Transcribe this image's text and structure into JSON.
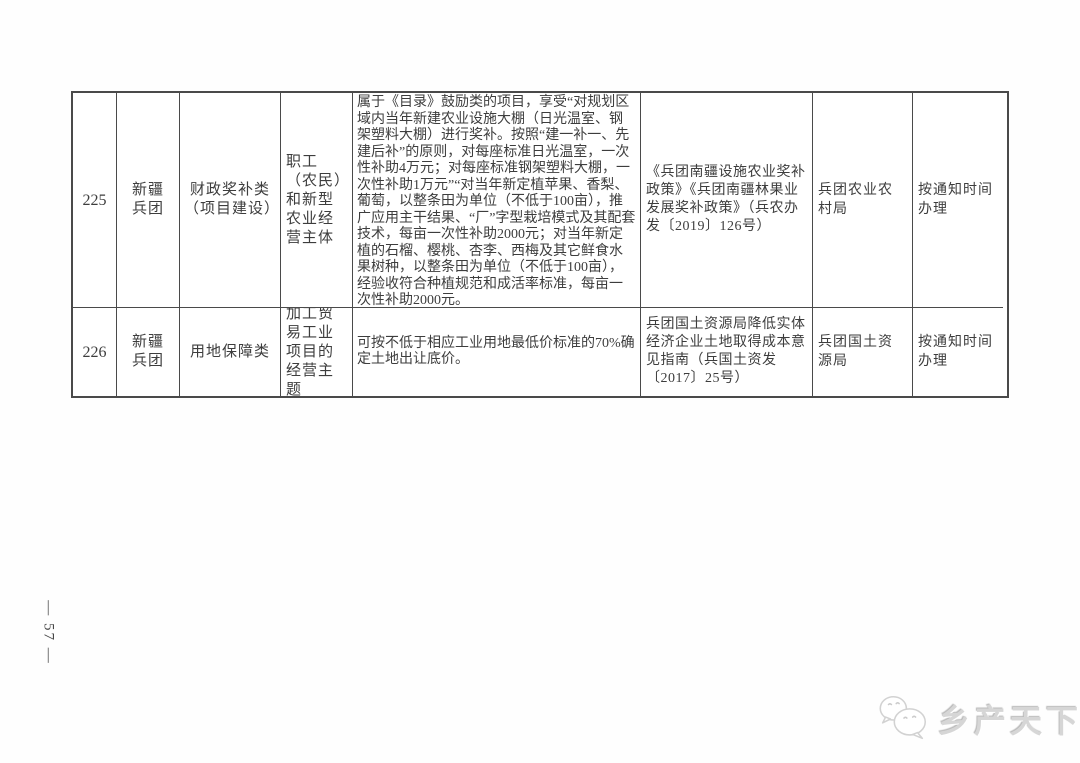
{
  "page": {
    "page_number": "— 57 —",
    "brand": {
      "name": "乡产天下",
      "icon": "chat-bubbles-icon",
      "color": "#d6d6d6"
    }
  },
  "table": {
    "border_color": "#4a4a4a",
    "rows": [
      {
        "no": "225",
        "region": "新疆兵团",
        "category": "财政奖补类（项目建设）",
        "applicant": "职工（农民）和新型农业经营主体",
        "content": "属于《目录》鼓励类的项目，享受“对规划区域内当年新建农业设施大棚（日光温室、钢架塑料大棚）进行奖补。按照“建一补一、先建后补”的原则，对每座标准日光温室，一次性补助4万元；对每座标准钢架塑料大棚，一次性补助1万元”“对当年新定植苹果、香梨、葡萄，以整条田为单位（不低于100亩），推广应用主干结果、“厂”字型栽培模式及其配套技术，每亩一次性补助2000元；对当年新定植的石榴、樱桃、杏李、西梅及其它鲜食水果树种，以整条田为单位（不低于100亩），经验收符合种植规范和成活率标准，每亩一次性补助2000元。",
        "policy_basis": "《兵团南疆设施农业奖补政策》《兵团南疆林果业发展奖补政策》（兵农办发〔2019〕126号）",
        "department": "兵团农业农村局",
        "handling_time": "按通知时间办理"
      },
      {
        "no": "226",
        "region": "新疆兵团",
        "category": "用地保障类",
        "applicant": "加工贸易工业项目的经营主题",
        "content": "可按不低于相应工业用地最低价标准的70%确定土地出让底价。",
        "policy_basis": "兵团国土资源局降低实体经济企业土地取得成本意见指南（兵国土资发〔2017〕25号）",
        "department": "兵团国土资源局",
        "handling_time": "按通知时间办理"
      }
    ]
  }
}
